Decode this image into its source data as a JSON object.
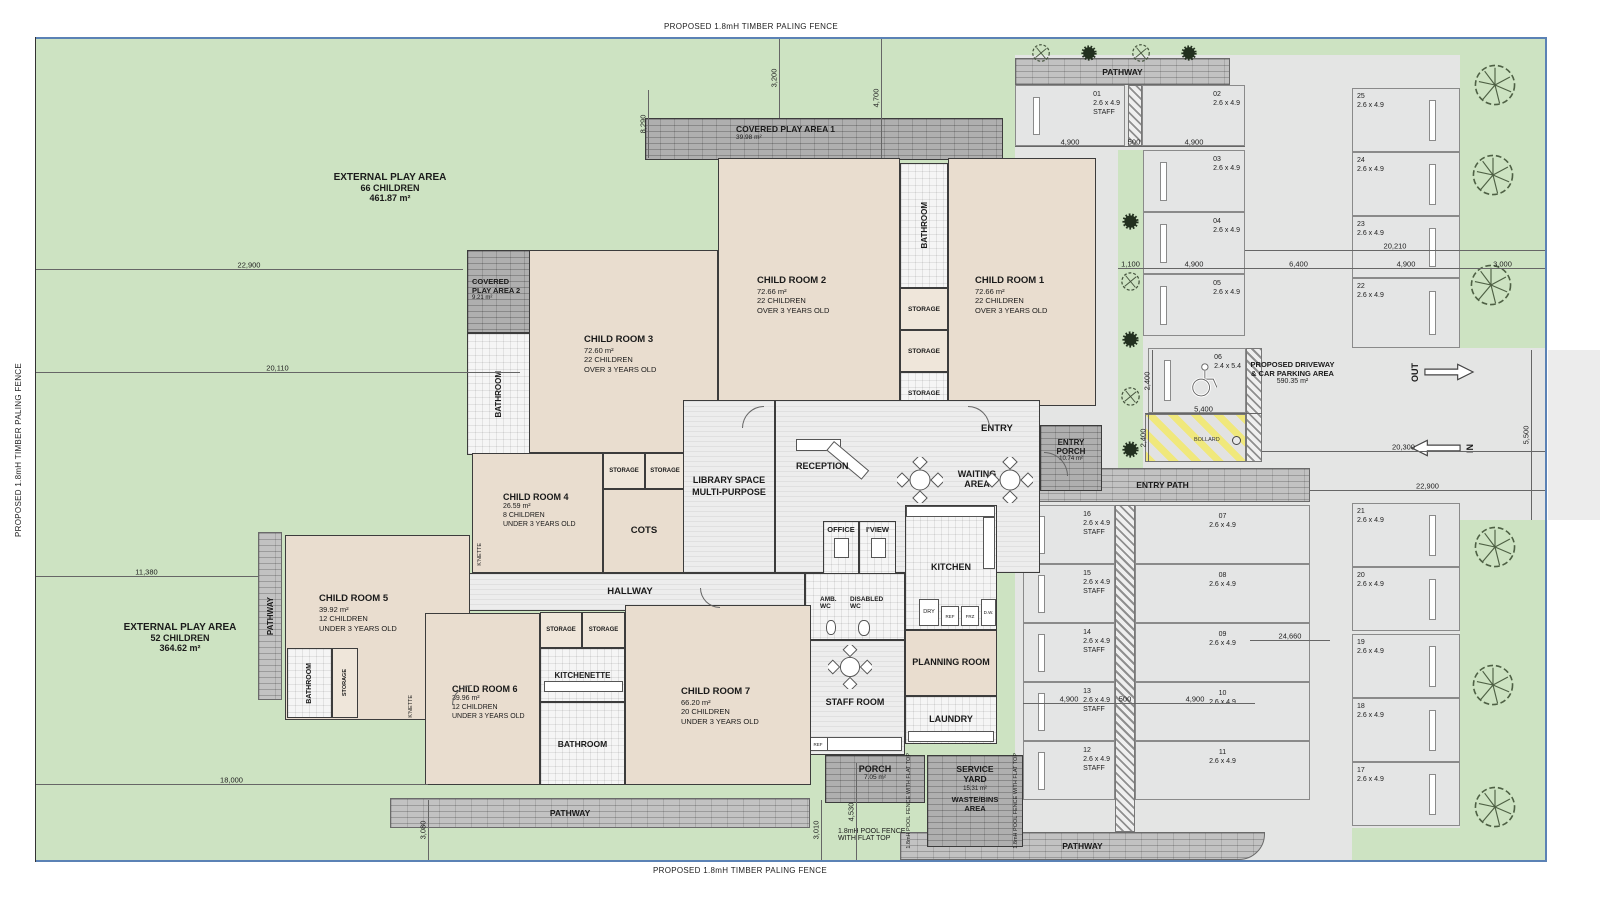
{
  "site": {
    "fence_top": "PROPOSED 1.8mH TIMBER PALING FENCE",
    "fence_bottom": "PROPOSED 1.8mH TIMBER PALING FENCE",
    "fence_left": "PROPOSED 1.8mH TIMBER PALING FENCE",
    "pool_fence_v1": "1.8mH POOL FENCE WITH FLAT TOP",
    "pool_fence_v2": "1.8mH POOL FENCE WITH FLAT TOP",
    "pool_fence_h1": "1.8mH POOL FENCE",
    "pool_fence_h2": "WITH FLAT TOP"
  },
  "play": {
    "ext1": {
      "name": "EXTERNAL PLAY AREA",
      "cap": "66 CHILDREN",
      "area": "461.87 m²"
    },
    "ext2": {
      "name": "EXTERNAL PLAY AREA",
      "cap": "52 CHILDREN",
      "area": "364.62 m²"
    },
    "cov1": {
      "name": "COVERED PLAY AREA 1",
      "area": "39.98 m²"
    },
    "cov2_line1": "COVERED",
    "cov2_line2": "PLAY AREA 2",
    "cov2_area": "9.21 m²"
  },
  "rooms": {
    "cr1": {
      "name": "CHILD ROOM 1",
      "area": "72.66 m²",
      "cap": "22 CHILDREN",
      "age": "OVER 3 YEARS OLD"
    },
    "cr2": {
      "name": "CHILD ROOM 2",
      "area": "72.66 m²",
      "cap": "22 CHILDREN",
      "age": "OVER 3 YEARS OLD"
    },
    "cr3": {
      "name": "CHILD ROOM 3",
      "area": "72.60 m²",
      "cap": "22 CHILDREN",
      "age": "OVER 3 YEARS OLD"
    },
    "cr4": {
      "name": "CHILD ROOM 4",
      "area": "26.59 m²",
      "cap": "8 CHILDREN",
      "age": "UNDER 3 YEARS OLD"
    },
    "cr5": {
      "name": "CHILD ROOM 5",
      "area": "39.92 m²",
      "cap": "12 CHILDREN",
      "age": "UNDER 3 YEARS OLD"
    },
    "cr6": {
      "name": "CHILD ROOM 6",
      "area": "39.96 m²",
      "cap": "12 CHILDREN",
      "age": "UNDER 3 YEARS OLD"
    },
    "cr7": {
      "name": "CHILD ROOM 7",
      "area": "66.20 m²",
      "cap": "20 CHILDREN",
      "age": "UNDER 3 YEARS OLD"
    },
    "library1": "LIBRARY SPACE",
    "library2": "MULTI-PURPOSE",
    "cots": "COTS",
    "hallway": "HALLWAY",
    "reception": "RECEPTION",
    "entry": "ENTRY",
    "waiting1": "WAITING",
    "waiting2": "AREA",
    "entry_porch1": "ENTRY",
    "entry_porch2": "PORCH",
    "entry_porch_area": "10.74 m²",
    "office": "OFFICE",
    "iview": "I'VIEW",
    "kitchen": "KITCHEN",
    "amb_wc1": "AMB.",
    "amb_wc2": "WC",
    "dis_wc1": "DISABLED",
    "dis_wc2": "WC",
    "staff_room": "STAFF ROOM",
    "planning_room": "PLANNING ROOM",
    "laundry": "LAUNDRY",
    "porch": "PORCH",
    "porch_area": "7.05 m²",
    "service1": "SERVICE",
    "service2": "YARD",
    "service_area": "15.31 m²",
    "waste1": "WASTE/BINS",
    "waste2": "AREA",
    "kitchenette": "KITCHENETTE",
    "bathroom": "BATHROOM",
    "storage": "STORAGE",
    "knette": "K'NETTE",
    "dry": "DRY",
    "ref": "REF",
    "frz": "FRZ",
    "dw": "D.W."
  },
  "pathway": "PATHWAY",
  "parking": {
    "driveway1": "PROPOSED DRIVEWAY",
    "driveway2": "& CAR PARKING AREA",
    "driveway_area": "590.35 m²",
    "out": "OUT",
    "in": "IN",
    "entry_path": "ENTRY PATH",
    "bollard": "BOLLARD",
    "spots": [
      {
        "num": "01",
        "size": "2.6 x 4.9",
        "tag": "STAFF"
      },
      {
        "num": "02",
        "size": "2.6 x 4.9"
      },
      {
        "num": "03",
        "size": "2.6 x 4.9"
      },
      {
        "num": "04",
        "size": "2.6 x 4.9"
      },
      {
        "num": "05",
        "size": "2.6 x 4.9"
      },
      {
        "num": "06",
        "size": "2.4 x 5.4"
      },
      {
        "num": "07",
        "size": "2.6 x 4.9"
      },
      {
        "num": "08",
        "size": "2.6 x 4.9"
      },
      {
        "num": "09",
        "size": "2.6 x 4.9"
      },
      {
        "num": "10",
        "size": "2.6 x 4.9"
      },
      {
        "num": "11",
        "size": "2.6 x 4.9"
      },
      {
        "num": "12",
        "size": "2.6 x 4.9",
        "tag": "STAFF"
      },
      {
        "num": "13",
        "size": "2.6 x 4.9",
        "tag": "STAFF"
      },
      {
        "num": "14",
        "size": "2.6 x 4.9",
        "tag": "STAFF"
      },
      {
        "num": "15",
        "size": "2.6 x 4.9",
        "tag": "STAFF"
      },
      {
        "num": "16",
        "size": "2.6 x 4.9",
        "tag": "STAFF"
      },
      {
        "num": "17",
        "size": "2.6 x 4.9"
      },
      {
        "num": "18",
        "size": "2.6 x 4.9"
      },
      {
        "num": "19",
        "size": "2.6 x 4.9"
      },
      {
        "num": "20",
        "size": "2.6 x 4.9"
      },
      {
        "num": "21",
        "size": "2.6 x 4.9"
      },
      {
        "num": "22",
        "size": "2.6 x 4.9"
      },
      {
        "num": "23",
        "size": "2.6 x 4.9"
      },
      {
        "num": "24",
        "size": "2.6 x 4.9"
      },
      {
        "num": "25",
        "size": "2.6 x 4.9"
      }
    ]
  },
  "dims": {
    "left_a": "22,900",
    "left_b": "20,110",
    "left_c": "11,380",
    "left_d": "18,000",
    "top_a": "3,200",
    "top_b": "4,700",
    "top_c": "8,290",
    "ptop_a": "4,900",
    "ptop_b": "500",
    "ptop_c": "4,900",
    "mid_a": "1,100",
    "mid_b": "4,900",
    "mid_c": "6,400",
    "mid_d": "4,900",
    "mid_e": "3,000",
    "mid_f": "20,210",
    "dis_a": "2,400",
    "dis_b": "2,400",
    "dis_c": "5,400",
    "drv_a": "20,300",
    "drv_b": "22,900",
    "drv_c": "5,500",
    "low_a": "24,660",
    "low_b": "4,900",
    "low_c": "500",
    "low_d": "4,900",
    "bot_a": "3,080",
    "bot_b": "3,010",
    "bot_c": "4,530"
  }
}
